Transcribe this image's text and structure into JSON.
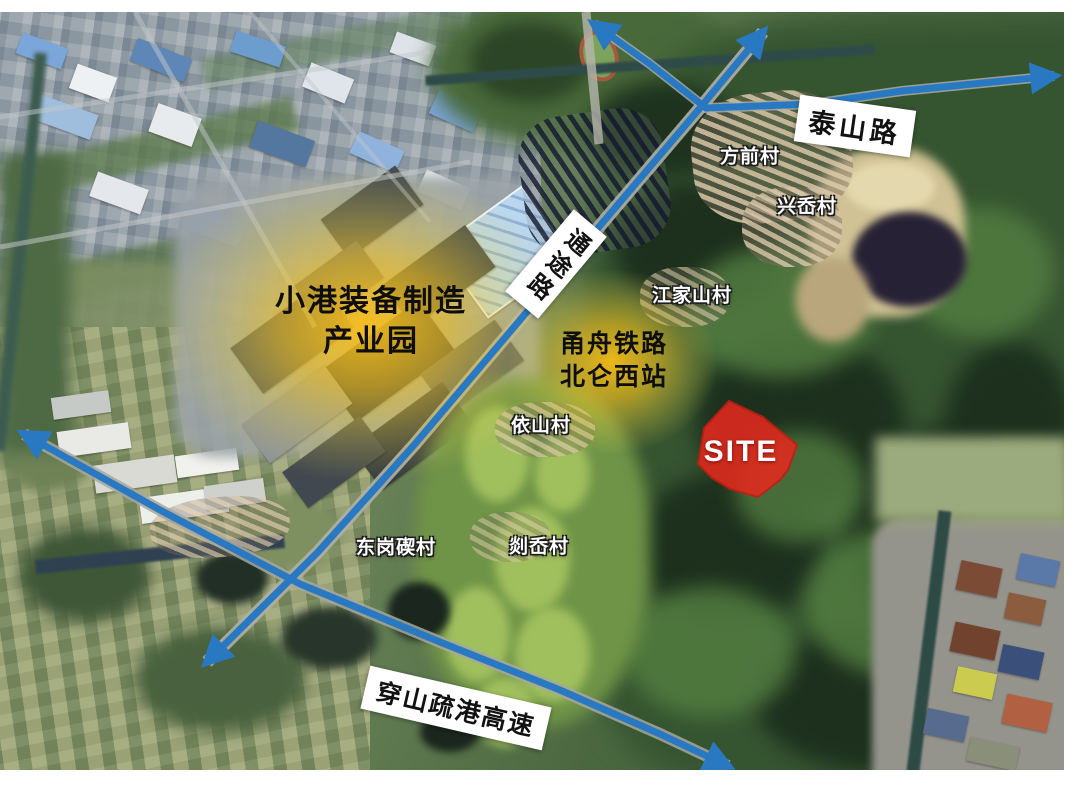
{
  "colors": {
    "road_line": "#2879c2",
    "glow": "#fbbf17",
    "site": "#e3291d",
    "label_bg": "#ffffff"
  },
  "zones": {
    "industrial_park": {
      "line1": "小港装备制造",
      "line2": "产业园"
    },
    "railway_station": {
      "line1": "甬舟铁路",
      "line2": "北仑西站"
    },
    "site_label": "SITE"
  },
  "roads": [
    {
      "name": "泰山路"
    },
    {
      "name": "通途路"
    },
    {
      "name": "穿山疏港高速"
    }
  ],
  "villages": [
    {
      "name": "方前村"
    },
    {
      "name": "兴岙村"
    },
    {
      "name": "江家山村"
    },
    {
      "name": "依山村"
    },
    {
      "name": "东岗碶村"
    },
    {
      "name": "剡岙村"
    }
  ]
}
